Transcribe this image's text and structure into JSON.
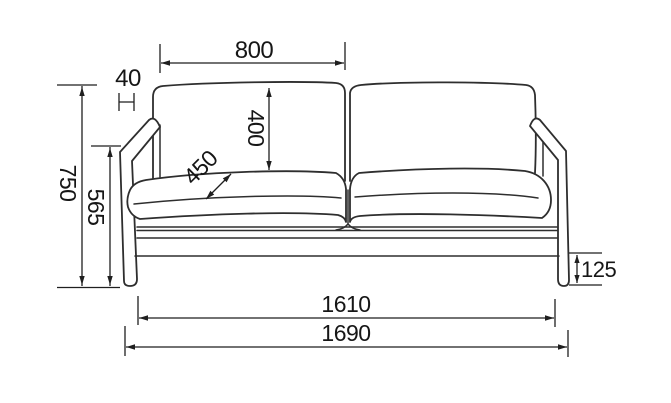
{
  "diagram": {
    "kind": "sofa front-elevation dimension drawing",
    "background": "#ffffff",
    "line_color": "#2e2e2e",
    "dimension_color": "#1f1f1f",
    "dimensions": {
      "cushion_width": "800",
      "arm_thickness": "40",
      "backrest_height": "400",
      "seat_depth": "450",
      "total_height": "750",
      "arm_height": "565",
      "leg_height": "125",
      "inner_width": "1610",
      "total_width": "1690"
    }
  }
}
